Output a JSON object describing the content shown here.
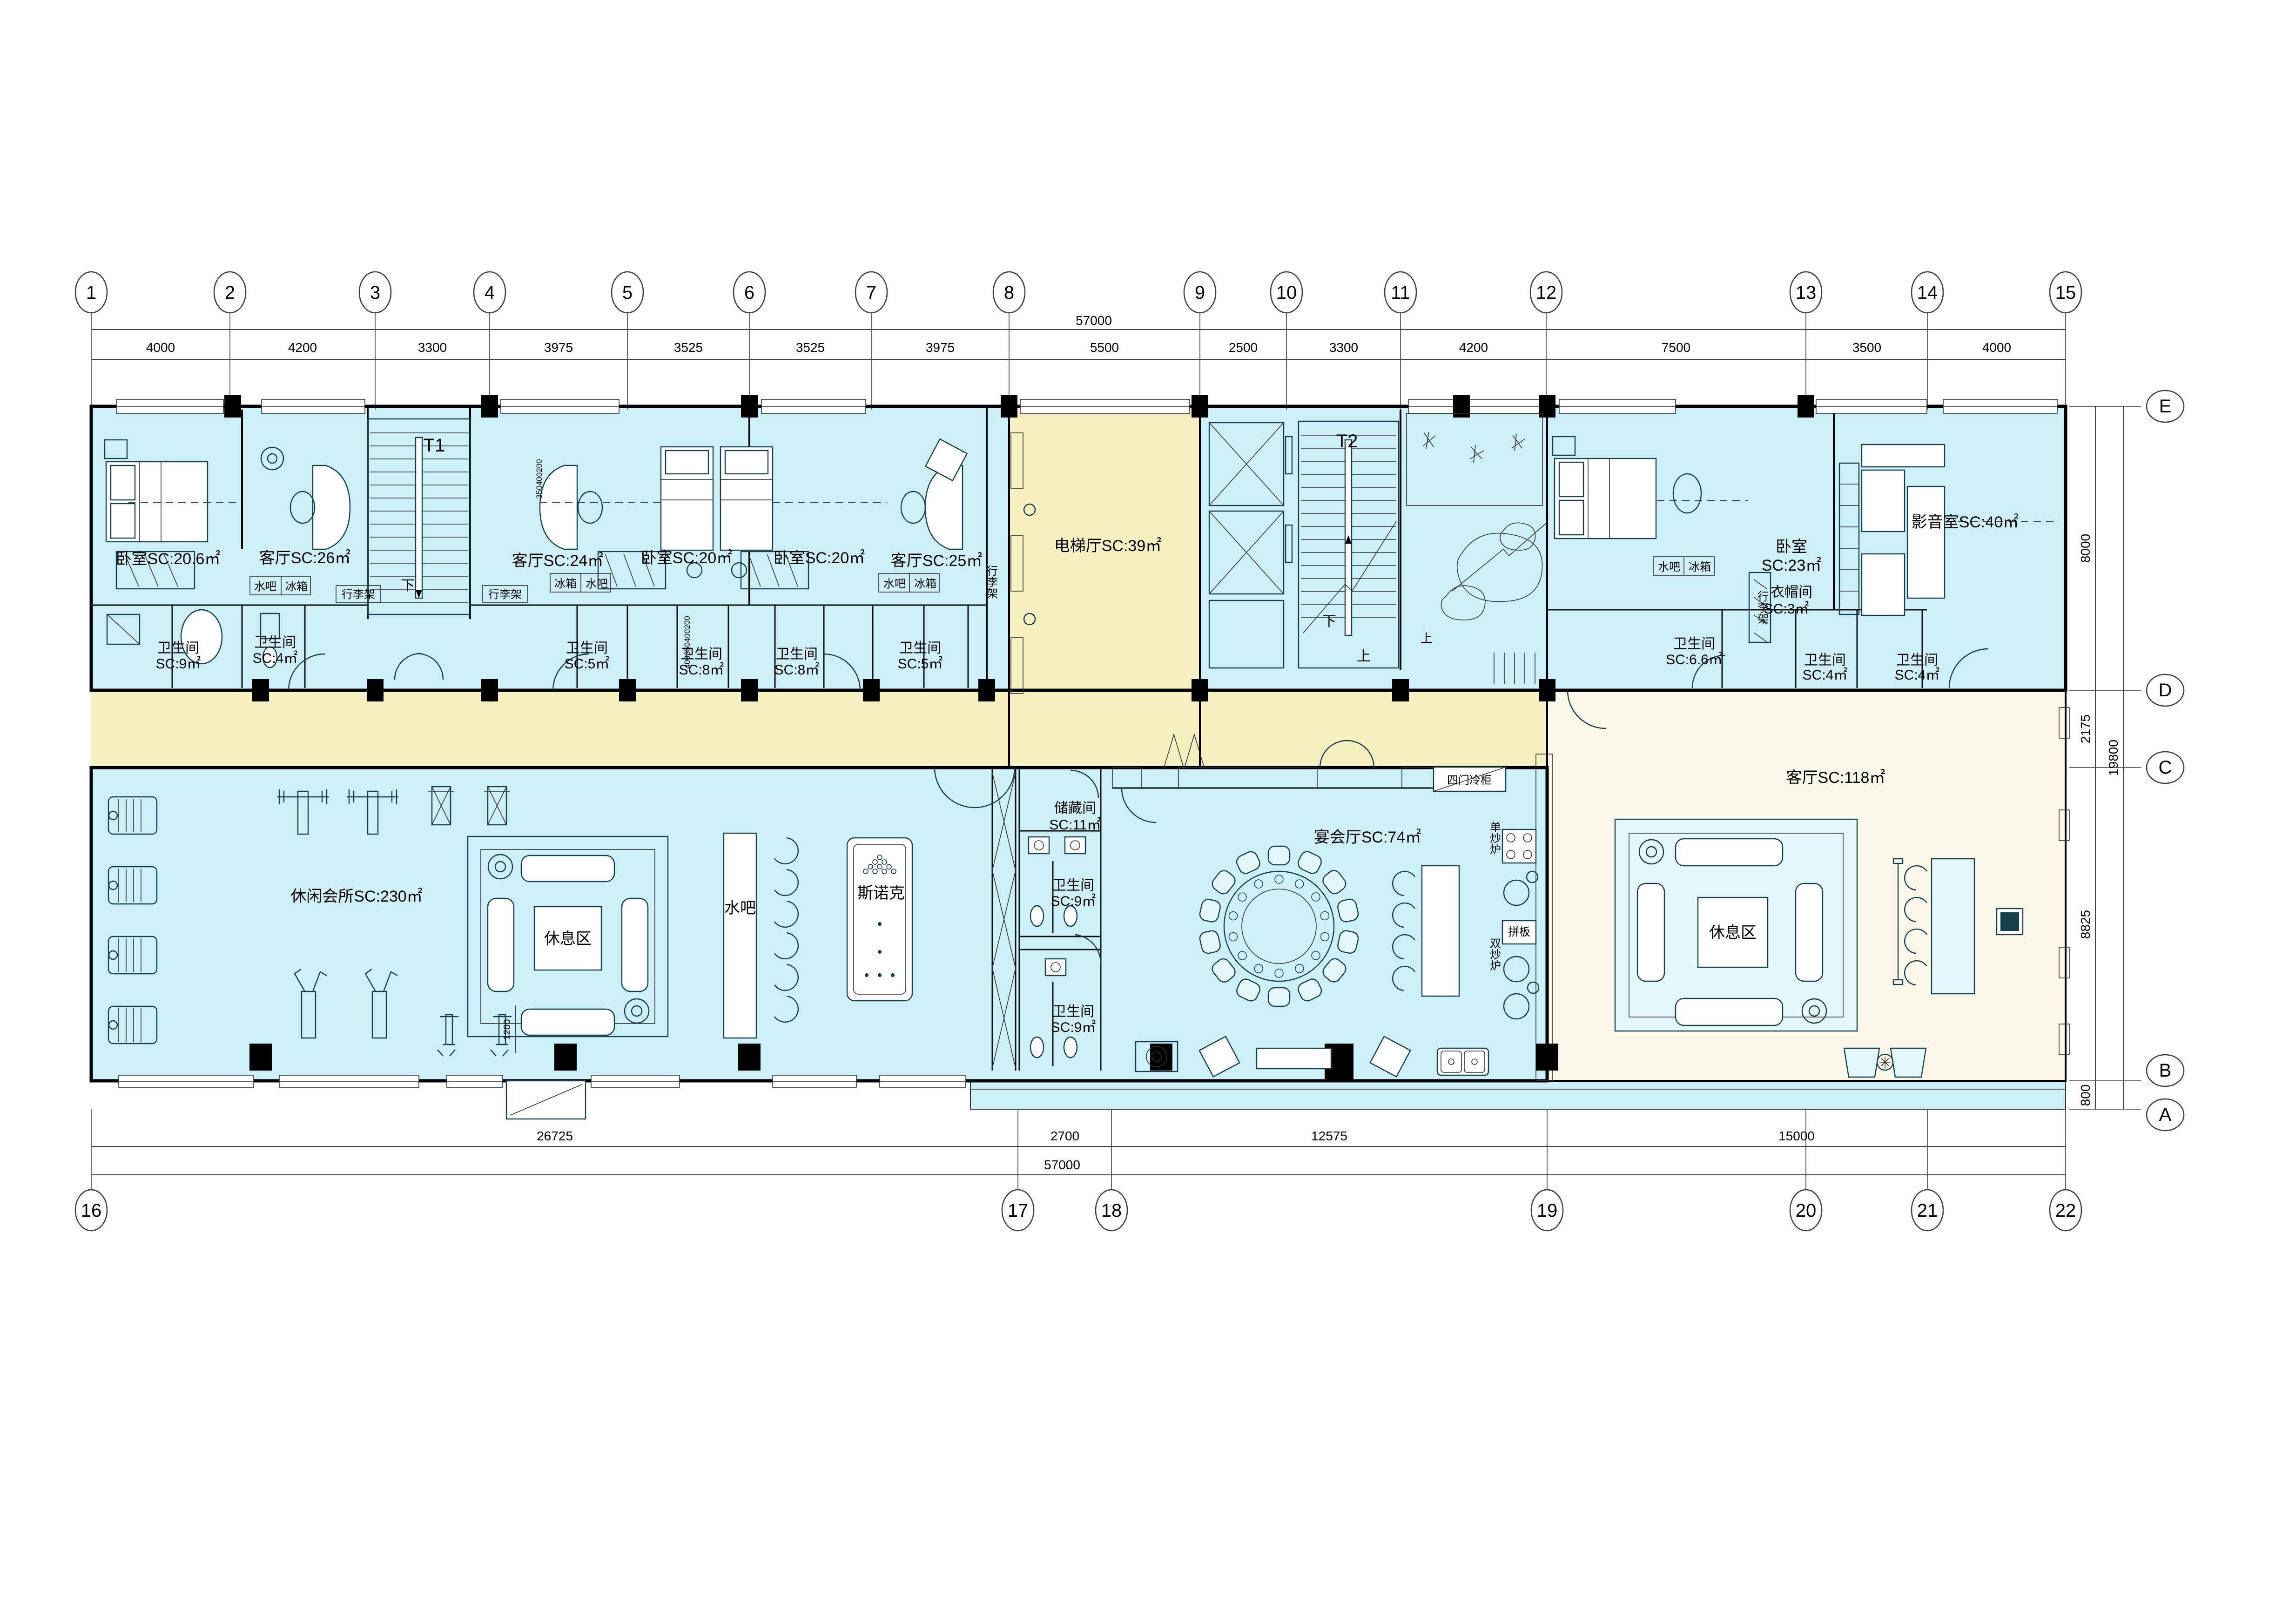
{
  "drawing": {
    "type": "architectural floor plan",
    "units": "mm"
  },
  "grid_top": {
    "bubbles": [
      "1",
      "2",
      "3",
      "4",
      "5",
      "6",
      "7",
      "8",
      "9",
      "10",
      "11",
      "12",
      "13",
      "14",
      "15"
    ],
    "dims": [
      "4000",
      "4200",
      "3300",
      "3975",
      "3525",
      "3525",
      "3975",
      "5500",
      "2500",
      "3300",
      "4200",
      "7500",
      "3500",
      "4000"
    ],
    "total": "57000"
  },
  "grid_bottom": {
    "bubbles": [
      "16",
      "17",
      "18",
      "19",
      "20",
      "21",
      "22"
    ],
    "dims": [
      "26725",
      "2700",
      "12575",
      "15000"
    ],
    "total": "57000"
  },
  "grid_right": {
    "bubbles": [
      "E",
      "D",
      "C",
      "B",
      "A"
    ],
    "dims": [
      "8000",
      "2175",
      "8825",
      "800"
    ],
    "total": "19800"
  },
  "rooms": {
    "bedroom_a": "卧室SC:20.6㎡",
    "living_a": "客厅SC:26㎡",
    "t1": "T1",
    "living_b": "客厅SC:24㎡",
    "bedroom_b": "卧室SC:20㎡",
    "bedroom_c": "卧室SC:20㎡",
    "living_c": "客厅SC:25㎡",
    "elev_hall": "电梯厅SC:39㎡",
    "t2": "T2",
    "bedroom_d_n": "卧室",
    "bedroom_d_a": "SC:23㎡",
    "av": "影音室SC:40㎡",
    "cloak_n": "衣帽间",
    "cloak_a": "SC:3㎡",
    "club": "休闲会所SC:230㎡",
    "rest1": "休息区",
    "bar1": "水吧",
    "snooker": "斯诺克",
    "store_n": "储藏间",
    "store_a": "SC:11㎡",
    "banquet": "宴会厅SC:74㎡",
    "living_main": "客厅SC:118㎡",
    "rest2": "休息区"
  },
  "baths": [
    {
      "n": "卫生间",
      "a": "SC:9㎡"
    },
    {
      "n": "卫生间",
      "a": "SC:4㎡"
    },
    {
      "n": "卫生间",
      "a": "SC:5㎡"
    },
    {
      "n": "卫生间",
      "a": "SC:8㎡"
    },
    {
      "n": "卫生间",
      "a": "SC:8㎡"
    },
    {
      "n": "卫生间",
      "a": "SC:5㎡"
    },
    {
      "n": "卫生间",
      "a": "SC:6.6㎡"
    },
    {
      "n": "卫生间",
      "a": "SC:4㎡"
    },
    {
      "n": "卫生间",
      "a": "SC:4㎡"
    },
    {
      "n": "卫生间",
      "a": "SC:9㎡"
    },
    {
      "n": "卫生间",
      "a": "SC:9㎡"
    }
  ],
  "labels": {
    "down": "下",
    "up": "上",
    "water_bar": "水吧",
    "fridge": "冰箱",
    "luggage": "行李架",
    "freezer": "四门冷柜",
    "wok_single": "单炒炉",
    "board": "拼板",
    "wok_double": "双炒炉"
  },
  "minor_dims": {
    "gym": "1200",
    "chain_a": "350400200",
    "chain_b": "400350400200"
  },
  "colors": {
    "room_blue": "#cdeff8",
    "corridor_yellow": "#f6f0c1",
    "hall_cream": "#fcf8e9",
    "wall_black": "#000000"
  }
}
